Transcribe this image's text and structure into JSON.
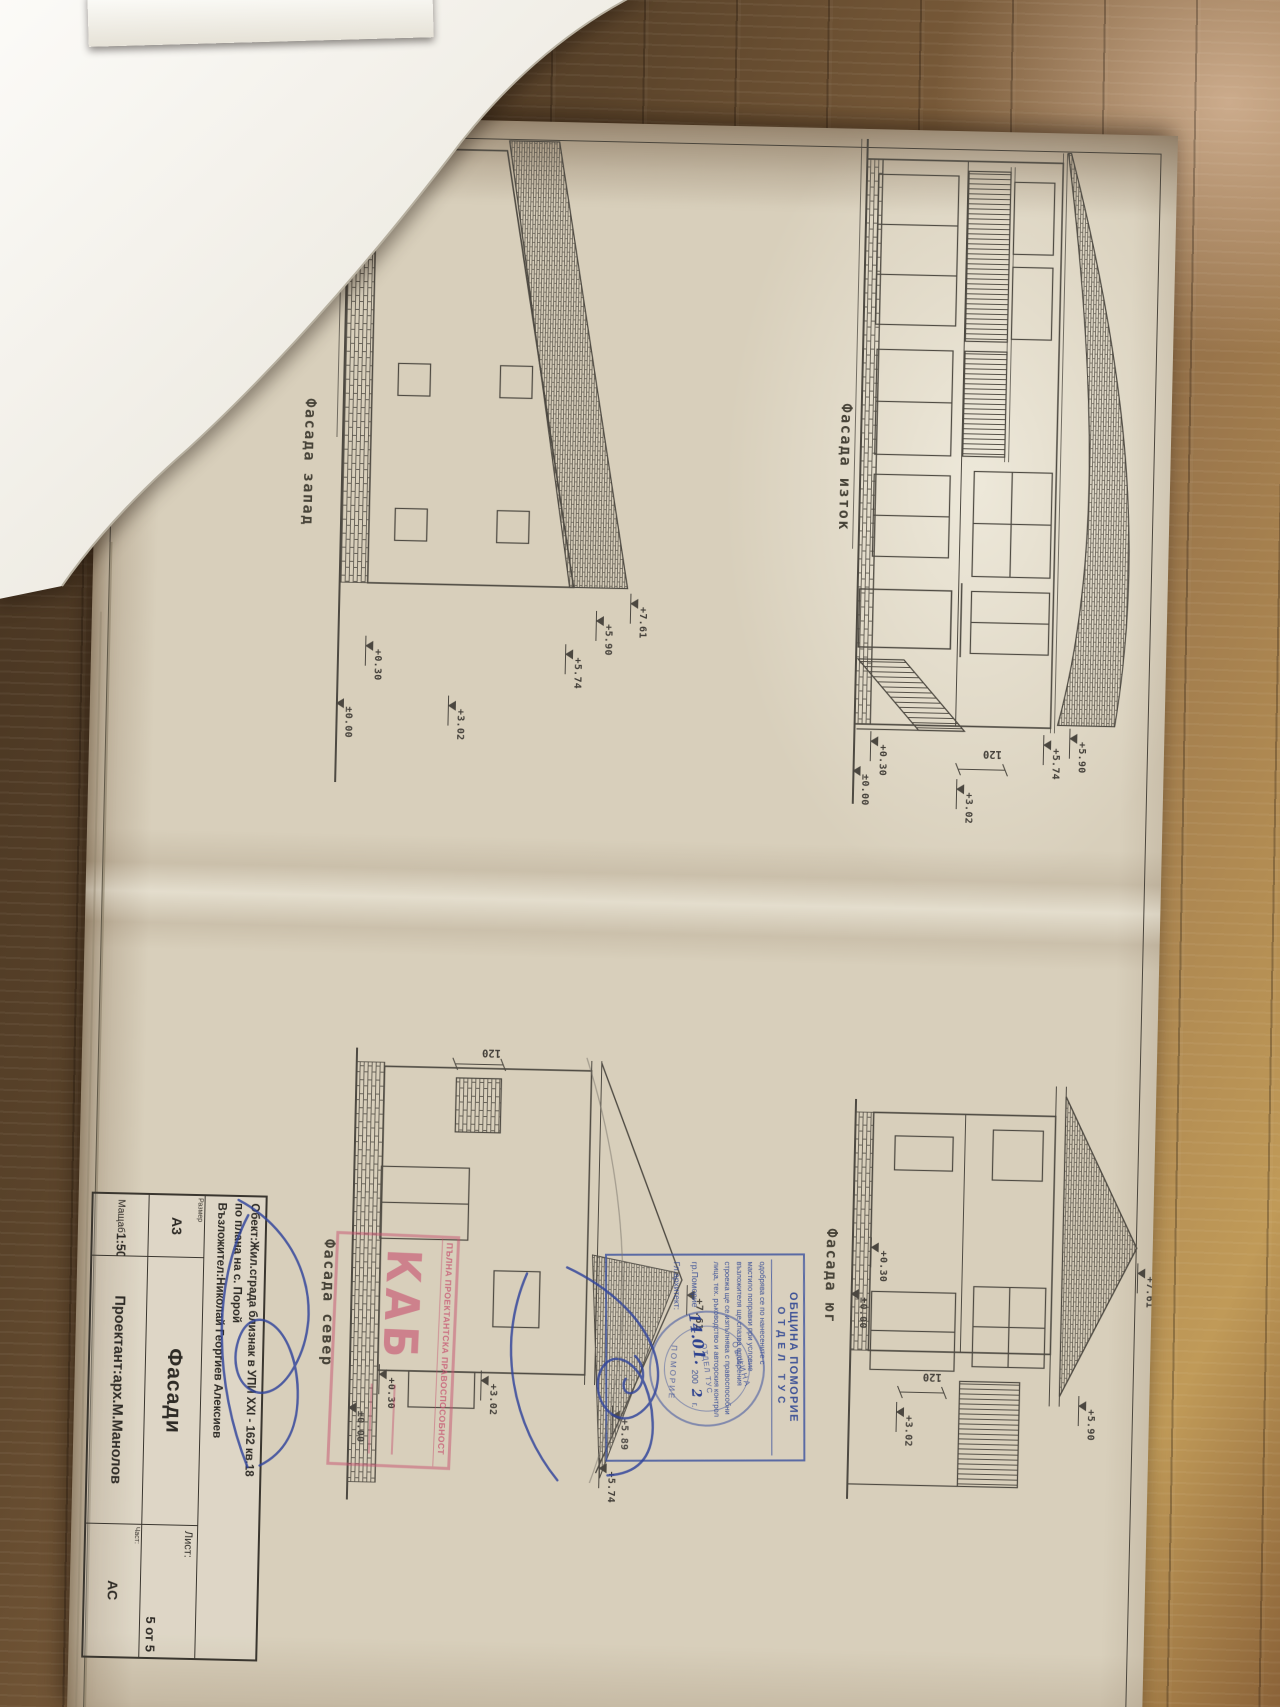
{
  "facades": {
    "east": {
      "label": "Фасада изток",
      "elevations": [
        "+5.90",
        "+5.74",
        "+3.02",
        "+0.30",
        "±0.00"
      ],
      "dim": "120"
    },
    "west": {
      "label": "Фасада запад",
      "elevations": [
        "+7.61",
        "+5.90",
        "+5.74",
        "+3.02",
        "+0.30",
        "±0.00"
      ]
    },
    "south": {
      "label": "Фасада юг",
      "elevations": [
        "+7.61",
        "+5.90",
        "+3.02",
        "+0.30",
        "±0.00"
      ],
      "dim": "120"
    },
    "north": {
      "label": "Фасада север",
      "elevations": [
        "+7.61",
        "+5.89",
        "+5.74",
        "+3.02",
        "+0.30",
        "±0.00"
      ],
      "dim": "120"
    }
  },
  "title_block": {
    "object_line1": "Обект:Жил.сграда близнак в УПИ XXI - 162 кв.18",
    "object_line2": "по плана на с. Порой",
    "object_line3": "Възложител:Николай Георгиев Алексиев",
    "size_label": "Размер",
    "size_value": "А3",
    "scale_label": "Мащаб",
    "scale_value": "1:50",
    "drawing_title": "Фасади",
    "designer": "Проектант:арх.М.Манолов",
    "sheet_label": "Лист:",
    "sheet_value": "5 от 5",
    "part_label": "Част:",
    "part_value": "АС"
  },
  "approval_stamp": {
    "municipality": "ОБЩИНА ПОМОРИЕ",
    "department": "ОТДЕЛ ТУС",
    "lines": [
      "одобрява се по нанесените с",
      "мастило поправки при условие",
      "възложителя ще спазва одобрения",
      "строежа ще се изпълнява с правоспособни",
      "лица, тех. ръководство и авторския контрол"
    ],
    "city": "гр.Поморие",
    "handwritten_date": "14.01.",
    "year_prefix": "200",
    "handwritten_year": "2",
    "year_suffix": "г.",
    "architect_label": "Гл.архитект:"
  },
  "round_seal": {
    "top": "ОБЩИНА",
    "bottom": "ПОМОРИЕ",
    "center": "ОТДЕЛ ТУС"
  },
  "license_stamp": {
    "caption": "ПЪЛНА ПРОЕКТАНТСКА ПРАВОСПОСОБНОСТ",
    "logo": "КАБ"
  }
}
